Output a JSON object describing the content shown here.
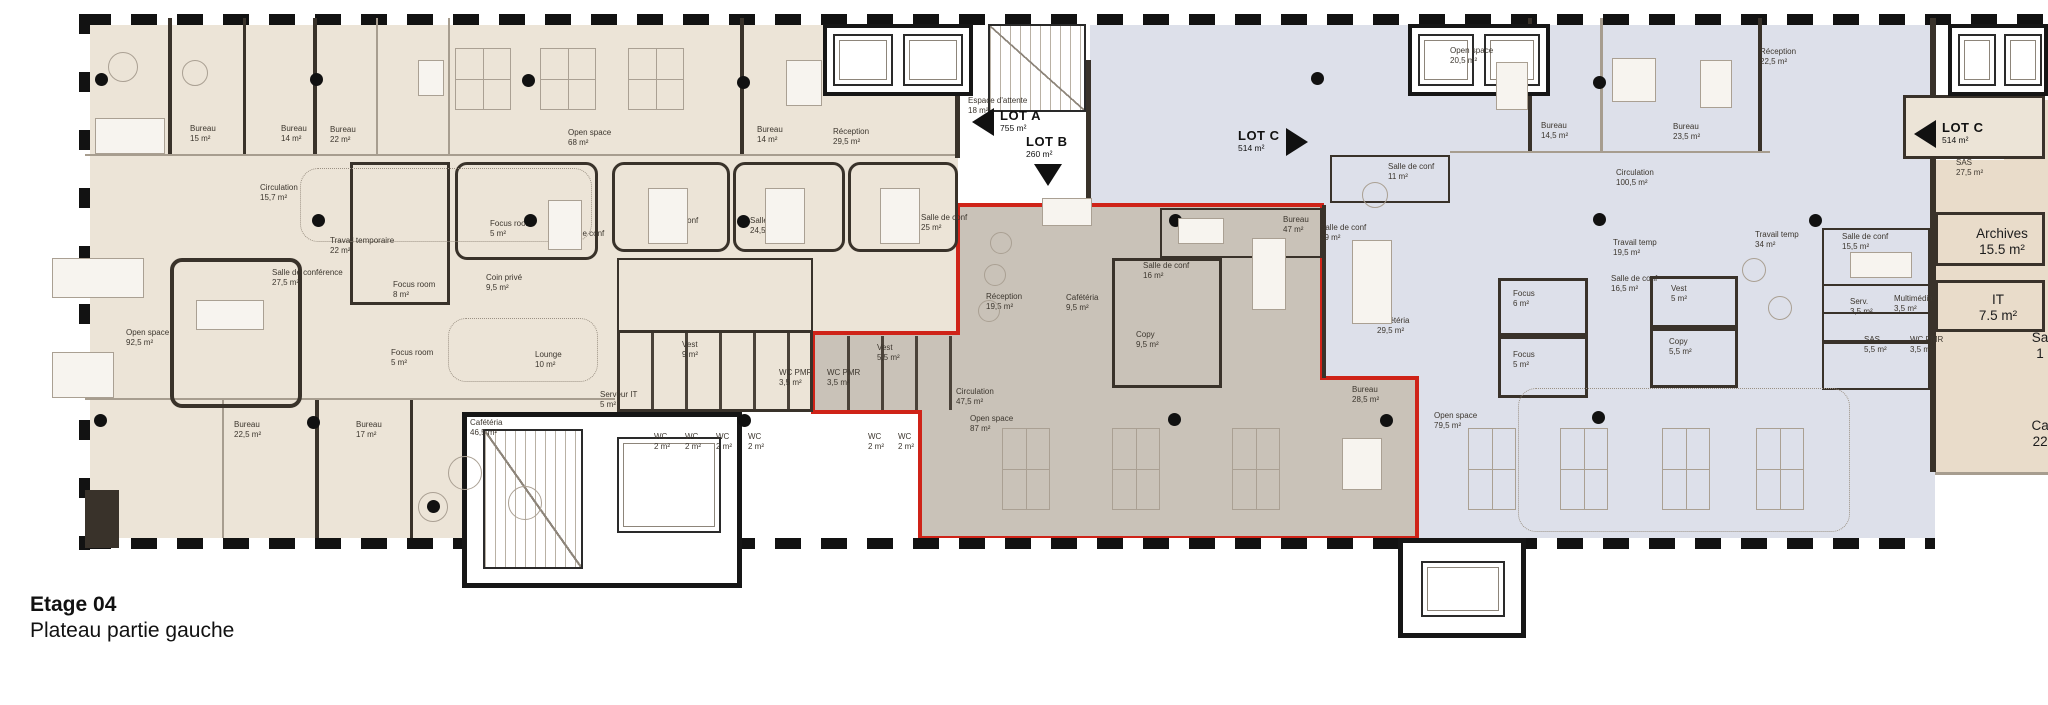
{
  "title": {
    "line1": "Etage 04",
    "line2": "Plateau partie gauche"
  },
  "colors": {
    "lot_left_fill": "#ece4d7",
    "lot_b_fill": "#c9c2b8",
    "lot_right_fill": "#dde0ea",
    "red_outline": "#cf2318",
    "wall": "#39322a"
  },
  "lots": [
    {
      "label": "LOT A",
      "area": "755 m²",
      "arrow": "left",
      "x": 1000,
      "y": 108
    },
    {
      "label": "LOT B",
      "area": "260 m²",
      "arrow": "down",
      "x": 1026,
      "y": 134
    },
    {
      "label": "LOT C",
      "area": "514 m²",
      "arrow": "right",
      "x": 1238,
      "y": 128
    },
    {
      "label": "LOT C",
      "area": "514 m²",
      "arrow": "left",
      "x": 1942,
      "y": 120
    }
  ],
  "rooms": [
    {
      "label": "Bureau",
      "area": "44,5 m²",
      "x": 128,
      "y": 120
    },
    {
      "label": "Bureau",
      "area": "15 m²",
      "x": 190,
      "y": 124
    },
    {
      "label": "Bureau",
      "area": "14 m²",
      "x": 281,
      "y": 124
    },
    {
      "label": "Bureau",
      "area": "22 m²",
      "x": 330,
      "y": 125
    },
    {
      "label": "Open space",
      "area": "68 m²",
      "x": 568,
      "y": 128
    },
    {
      "label": "Bureau",
      "area": "14 m²",
      "x": 757,
      "y": 125
    },
    {
      "label": "Réception",
      "area": "29,5 m²",
      "x": 833,
      "y": 127
    },
    {
      "label": "Circulation",
      "area": "15,7 m²",
      "x": 260,
      "y": 183
    },
    {
      "label": "Travail temporaire",
      "area": "22 m²",
      "x": 330,
      "y": 236
    },
    {
      "label": "Salle de conférence",
      "area": "27,5 m²",
      "x": 272,
      "y": 268
    },
    {
      "label": "Focus room",
      "area": "8 m²",
      "x": 393,
      "y": 280
    },
    {
      "label": "Focus room",
      "area": "5 m²",
      "x": 490,
      "y": 219
    },
    {
      "label": "Coin privé",
      "area": "9,5 m²",
      "x": 486,
      "y": 273
    },
    {
      "label": "Salle de conf",
      "area": "18 m²",
      "x": 558,
      "y": 229
    },
    {
      "label": "Lounge",
      "area": "10 m²",
      "x": 535,
      "y": 350
    },
    {
      "label": "Salle de conf",
      "area": "22,5 m²",
      "x": 652,
      "y": 216
    },
    {
      "label": "Salle de conf",
      "area": "24,5 m²",
      "x": 750,
      "y": 216
    },
    {
      "label": "Salle de conf",
      "area": "25 m²",
      "x": 921,
      "y": 213
    },
    {
      "label": "Open space",
      "area": "92,5 m²",
      "x": 126,
      "y": 328
    },
    {
      "label": "Focus room",
      "area": "5 m²",
      "x": 391,
      "y": 348
    },
    {
      "label": "Vest",
      "area": "9 m²",
      "x": 682,
      "y": 340
    },
    {
      "label": "WC PMR",
      "area": "3,5 m²",
      "x": 779,
      "y": 368
    },
    {
      "label": "Serveur IT",
      "area": "5 m²",
      "x": 600,
      "y": 390
    },
    {
      "label": "Bureau",
      "area": "22,5 m²",
      "x": 234,
      "y": 420
    },
    {
      "label": "Bureau",
      "area": "17 m²",
      "x": 356,
      "y": 420
    },
    {
      "label": "Cafétéria",
      "area": "46,5 m²",
      "x": 470,
      "y": 418
    },
    {
      "label": "WC",
      "area": "2 m²",
      "x": 654,
      "y": 432
    },
    {
      "label": "WC",
      "area": "2 m²",
      "x": 685,
      "y": 432
    },
    {
      "label": "WC",
      "area": "2 m²",
      "x": 716,
      "y": 432
    },
    {
      "label": "WC",
      "area": "2 m²",
      "x": 748,
      "y": 432
    },
    {
      "label": "WC",
      "area": "2 m²",
      "x": 868,
      "y": 432
    },
    {
      "label": "WC",
      "area": "2 m²",
      "x": 898,
      "y": 432
    },
    {
      "label": "Espace d'attente",
      "area": "18 m²",
      "x": 968,
      "y": 96
    },
    {
      "label": "WC PMR",
      "area": "3,5 m²",
      "x": 827,
      "y": 368
    },
    {
      "label": "Vest",
      "area": "5,5 m²",
      "x": 877,
      "y": 343
    },
    {
      "label": "Réception",
      "area": "19,5 m²",
      "x": 986,
      "y": 292
    },
    {
      "label": "Cafétéria",
      "area": "9,5 m²",
      "x": 1066,
      "y": 293
    },
    {
      "label": "Salle de conf",
      "area": "16 m²",
      "x": 1143,
      "y": 261
    },
    {
      "label": "Copy",
      "area": "9,5 m²",
      "x": 1136,
      "y": 330
    },
    {
      "label": "Bureau",
      "area": "47 m²",
      "x": 1283,
      "y": 215
    },
    {
      "label": "Circulation",
      "area": "47,5 m²",
      "x": 956,
      "y": 387
    },
    {
      "label": "Open space",
      "area": "87 m²",
      "x": 970,
      "y": 414
    },
    {
      "label": "Bureau",
      "area": "28,5 m²",
      "x": 1352,
      "y": 385
    },
    {
      "label": "Open space",
      "area": "20,5 m²",
      "x": 1450,
      "y": 46
    },
    {
      "label": "Salle de conf",
      "area": "11 m²",
      "x": 1388,
      "y": 162
    },
    {
      "label": "Salle de conf",
      "area": "29 m²",
      "x": 1320,
      "y": 223
    },
    {
      "label": "Bureau",
      "area": "14,5 m²",
      "x": 1541,
      "y": 121
    },
    {
      "label": "Bureau",
      "area": "23,5 m²",
      "x": 1673,
      "y": 122
    },
    {
      "label": "Réception",
      "area": "22,5 m²",
      "x": 1760,
      "y": 47
    },
    {
      "label": "Circulation",
      "area": "100,5 m²",
      "x": 1616,
      "y": 168
    },
    {
      "label": "Travail temp",
      "area": "19,5 m²",
      "x": 1613,
      "y": 238
    },
    {
      "label": "Salle de conf",
      "area": "16,5 m²",
      "x": 1611,
      "y": 274
    },
    {
      "label": "Focus",
      "area": "6 m²",
      "x": 1513,
      "y": 289
    },
    {
      "label": "Focus",
      "area": "5 m²",
      "x": 1513,
      "y": 350
    },
    {
      "label": "Vest",
      "area": "5 m²",
      "x": 1671,
      "y": 284
    },
    {
      "label": "Copy",
      "area": "5,5 m²",
      "x": 1669,
      "y": 337
    },
    {
      "label": "Open space",
      "area": "79,5 m²",
      "x": 1434,
      "y": 411
    },
    {
      "label": "Travail temp",
      "area": "34 m²",
      "x": 1755,
      "y": 230
    },
    {
      "label": "Cafétéria",
      "area": "29,5 m²",
      "x": 1377,
      "y": 316
    },
    {
      "label": "Salle de conf",
      "area": "15,5 m²",
      "x": 1842,
      "y": 232
    },
    {
      "label": "Serv.",
      "area": "3,5 m²",
      "x": 1850,
      "y": 297
    },
    {
      "label": "Multimédia",
      "area": "3,5 m²",
      "x": 1894,
      "y": 294
    },
    {
      "label": "SAS",
      "area": "5,5 m²",
      "x": 1864,
      "y": 335
    },
    {
      "label": "WC PMR",
      "area": "3,5 m²",
      "x": 1910,
      "y": 335
    },
    {
      "label": "SAS",
      "area": "27,5 m²",
      "x": 1956,
      "y": 158
    },
    {
      "label": "Cafétéria",
      "area": "29,5 m²",
      "x": 1364,
      "y": 318,
      "hide": true
    }
  ],
  "big_rooms": [
    {
      "label": "Archives",
      "area": "15.5 m²",
      "x": 1992,
      "y": 226
    },
    {
      "label": "IT",
      "area": "7.5 m²",
      "x": 1988,
      "y": 292
    },
    {
      "label": "Sa",
      "area": "1",
      "x": 2030,
      "y": 330
    },
    {
      "label": "Caf",
      "area": "22.",
      "x": 2032,
      "y": 418
    }
  ]
}
